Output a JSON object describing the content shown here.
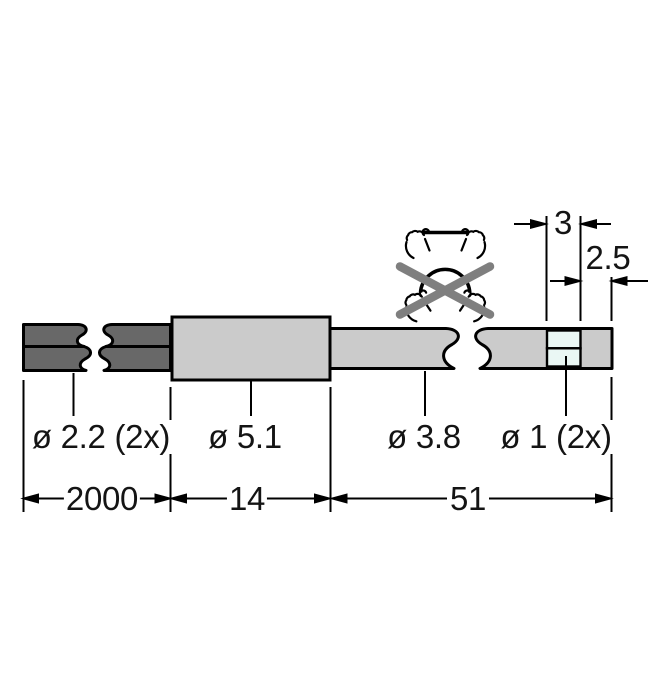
{
  "drawing": {
    "type": "technical-dimension-drawing",
    "labels": {
      "duplex_cable_diameter": "ø 2.2 (2x)",
      "sleeve_diameter": "ø 5.1",
      "fiber_cable_diameter": "ø 3.8",
      "fiber_tip_diameter": "ø 1 (2x)",
      "duplex_cable_length": "2000",
      "sleeve_length": "14",
      "fiber_section_length": "51",
      "tip_window_width": "3",
      "tip_end_offset": "2.5"
    },
    "icons": {
      "do_not_bend": "do-not-bend-icon",
      "hands_straight": "hands-holding-straight-fiber-icon",
      "hands_bent": "hands-bending-fiber-icon",
      "prohibition_cross": "prohibition-x-icon"
    },
    "colors": {
      "outline": "#000000",
      "cable_dark": "#686868",
      "body_gray": "#cbcbcb",
      "window_fill": "#eaf7f4",
      "prohibition_x": "#7f7f7f",
      "text": "#141414",
      "background": "#ffffff"
    }
  }
}
